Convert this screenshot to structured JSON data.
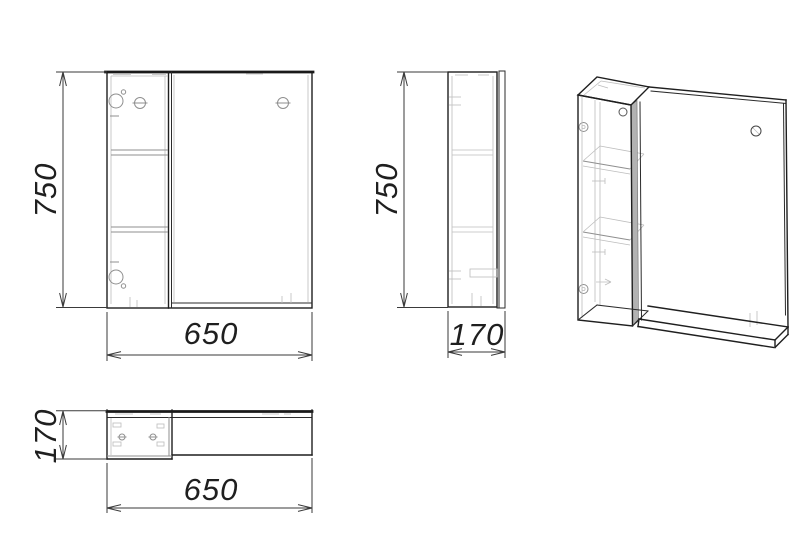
{
  "drawing": {
    "views": {
      "front": {
        "height": "750",
        "width": "650"
      },
      "side": {
        "height": "750",
        "depth": "170"
      },
      "top": {
        "depth": "170",
        "width": "650"
      }
    },
    "colors": {
      "background": "#ffffff",
      "main_line": "#1f1f1f",
      "faint_line": "#bdbdbd",
      "dimension_line": "#3a3a3a",
      "door_edge_fill": "#b2b2b2"
    }
  }
}
